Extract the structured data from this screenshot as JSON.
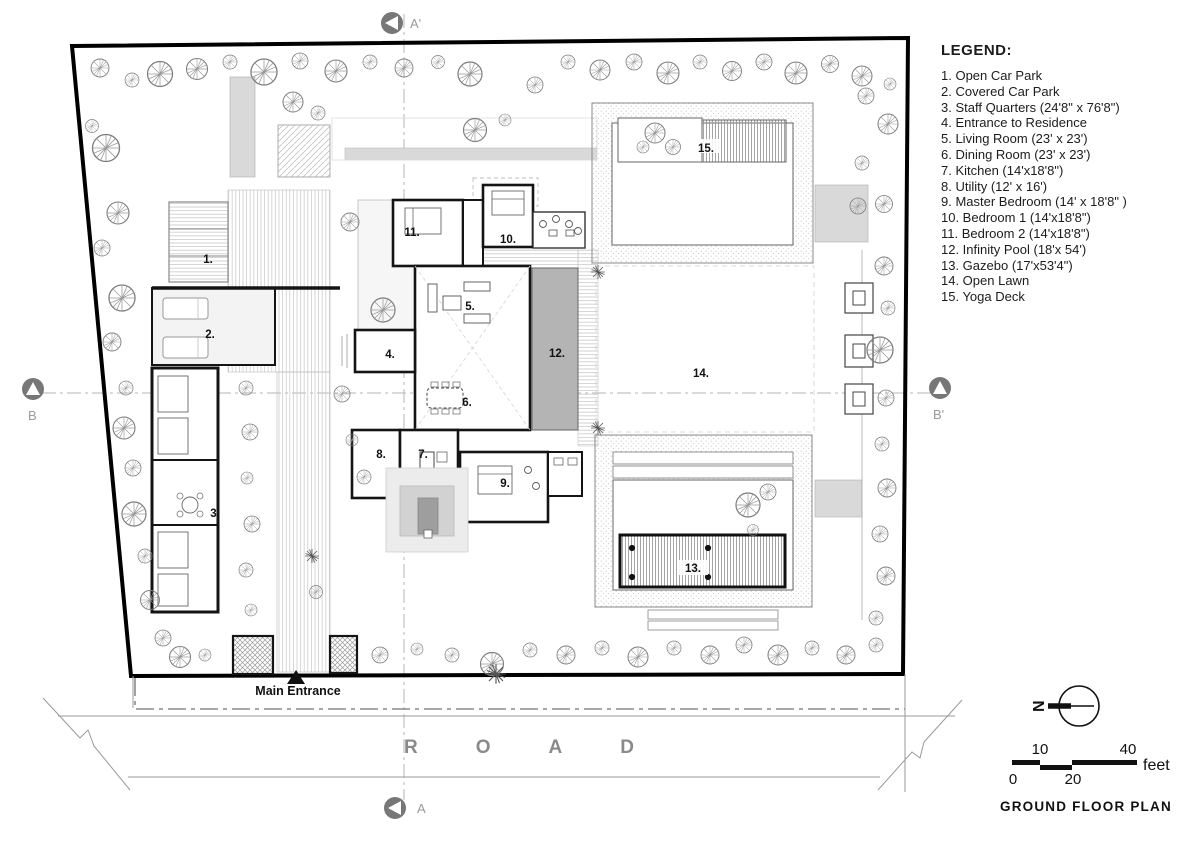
{
  "legend": {
    "title": "LEGEND:",
    "items": [
      "1. Open Car Park",
      "2. Covered Car Park",
      "3. Staff Quarters (24'8\" x 76'8\")",
      "4. Entrance to Residence",
      "5. Living Room (23' x 23')",
      "6. Dining Room (23' x 23')",
      "7. Kitchen (14'x18'8\")",
      "8. Utility (12' x 16')",
      "9. Master Bedroom (14' x 18'8\" )",
      "10. Bedroom 1 (14'x18'8\")",
      "11. Bedroom 2 (14'x18'8\")",
      "12. Infinity Pool (18'x 54')",
      "13. Gazebo (17'x53'4\")",
      "14. Open Lawn",
      "15. Yoga Deck"
    ]
  },
  "plan": {
    "rooms": [
      "1.",
      "2.",
      "3.",
      "4.",
      "5.",
      "6.",
      "7.",
      "8.",
      "9.",
      "10.",
      "11.",
      "12.",
      "13.",
      "14.",
      "15."
    ],
    "main_entrance": "Main Entrance",
    "road": "ROAD"
  },
  "markers": {
    "a_top": "A'",
    "a_bottom": "A",
    "b_left": "B",
    "b_right": "B'"
  },
  "north": {
    "label": "N"
  },
  "scale": {
    "ticks": [
      "0",
      "10",
      "20",
      "40"
    ],
    "unit": "feet"
  },
  "title": "GROUND FLOOR PLAN",
  "colors": {
    "line": "#111111",
    "gray_fill": "#d9d9d9",
    "pool": "#b4b4b4",
    "muted_text": "#8a8a8a"
  }
}
